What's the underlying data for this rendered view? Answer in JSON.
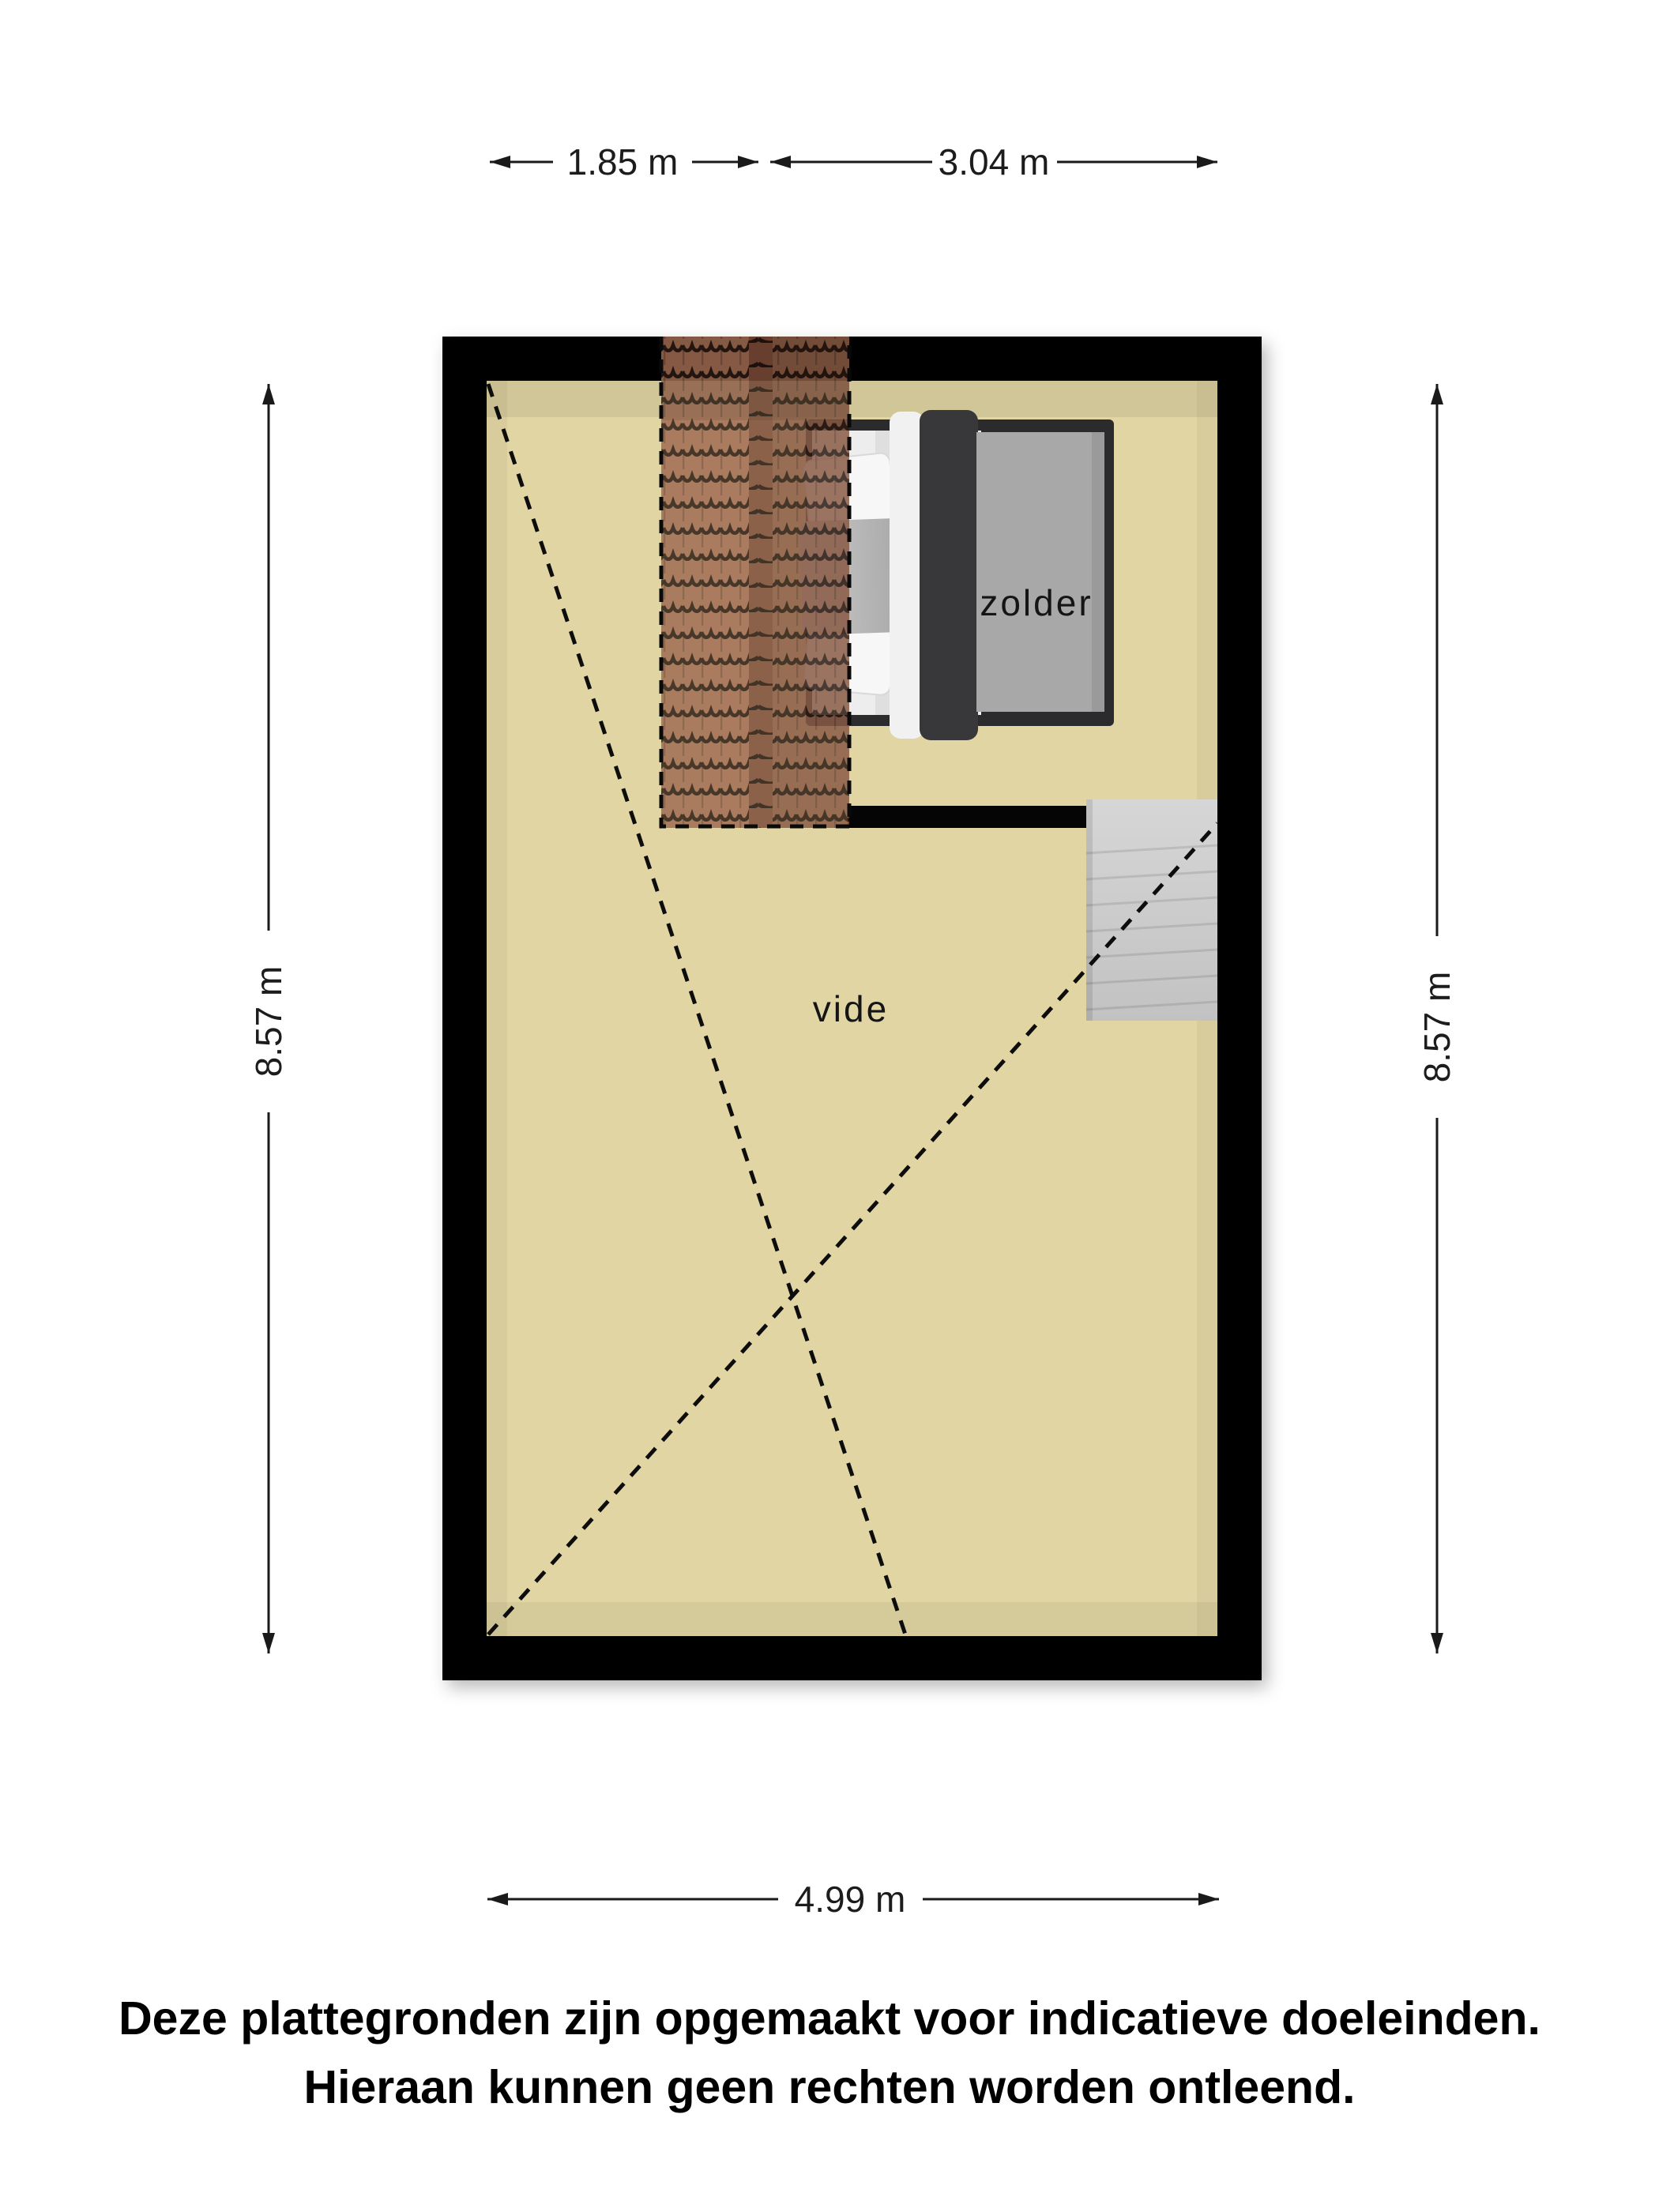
{
  "plan": {
    "rooms": {
      "attic": {
        "label": "zolder"
      },
      "void": {
        "label": "vide"
      }
    },
    "dimensions": {
      "top_left": "1.85 m",
      "top_right": "3.04 m",
      "left": "8.57 m",
      "right": "8.57 m",
      "bottom": "4.99 m"
    },
    "disclaimer": {
      "line1": "Deze plattegronden zijn opgemaakt voor indicatieve doeleinden.",
      "line2": "Hieraan kunnen geen rechten worden ontleend."
    },
    "colors": {
      "wall": "#050505",
      "floor": "#e1d5a3",
      "roof_tiles": "#a06b52",
      "stairs": "#cbcbcb",
      "bed_frame": "#2b2b2d",
      "bed_blanket": "#a8a8a8",
      "bed_duvet_band": "#38383b"
    }
  }
}
